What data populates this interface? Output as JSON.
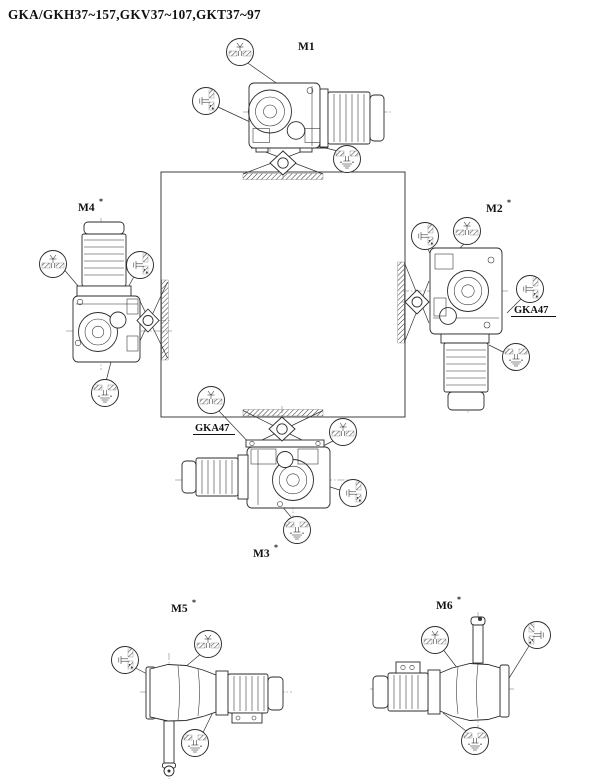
{
  "title": "GKA/GKH37~157,GKV37~107,GKT37~97",
  "positions": {
    "m1": {
      "label": "M1",
      "marker": ""
    },
    "m2": {
      "label": "M2",
      "marker": "*"
    },
    "m3": {
      "label": "M3",
      "marker": "*"
    },
    "m4": {
      "label": "M4",
      "marker": "*"
    },
    "m5": {
      "label": "M5",
      "marker": "*"
    },
    "m6": {
      "label": "M6",
      "marker": "*"
    }
  },
  "annotations": {
    "m2_variant_label": "GKA47",
    "m3_variant_label": "GKA47"
  },
  "icons": {
    "breather": "breather-plug-icon",
    "oil_level": "oil-level-plug-icon",
    "oil_drain": "oil-drain-plug-icon"
  },
  "colors": {
    "line": "#2b2b2b",
    "background": "#ffffff"
  }
}
